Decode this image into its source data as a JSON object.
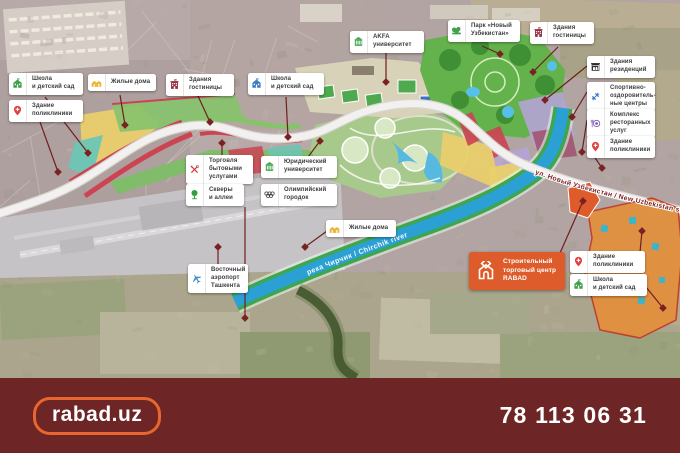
{
  "map": {
    "street_label": "ул. Новый Узбекистан / New Uzbekistan str.",
    "river_label": "река Чирчик / Chirchik river"
  },
  "labels": [
    {
      "name": "school-kindergarten-1",
      "icon": "school",
      "color": "#3fa24a",
      "x": 9,
      "y": 73,
      "w": 74,
      "lines": [
        "Школа",
        "и детский сад"
      ]
    },
    {
      "name": "residential-1",
      "icon": "houses",
      "color": "#eab73a",
      "x": 88,
      "y": 74,
      "w": 68,
      "lines": [
        "Жилые дома"
      ]
    },
    {
      "name": "hotel-1",
      "icon": "hotel",
      "color": "#93303f",
      "x": 166,
      "y": 74,
      "w": 68,
      "lines": [
        "Здания",
        "гостиницы"
      ]
    },
    {
      "name": "polyclinic-1",
      "icon": "pin",
      "color": "#e04040",
      "x": 9,
      "y": 100,
      "w": 74,
      "lines": [
        "Здание",
        "поликлиники"
      ]
    },
    {
      "name": "school-kindergarten-2",
      "icon": "school",
      "color": "#3d7dc0",
      "x": 248,
      "y": 73,
      "w": 76,
      "lines": [
        "Школа",
        "и детский сад"
      ]
    },
    {
      "name": "akfa-university",
      "icon": "university",
      "color": "#3fa24a",
      "x": 350,
      "y": 31,
      "w": 74,
      "lines": [
        "AKFA",
        "университет"
      ]
    },
    {
      "name": "park-new-uzbekistan",
      "icon": "park",
      "color": "#3fa24a",
      "x": 448,
      "y": 20,
      "w": 72,
      "lines": [
        "Парк «Новый",
        "Узбекистан»"
      ]
    },
    {
      "name": "hotel-2",
      "icon": "hotel",
      "color": "#93303f",
      "x": 530,
      "y": 22,
      "w": 64,
      "lines": [
        "Здания",
        "гостиницы"
      ]
    },
    {
      "name": "residences",
      "icon": "palace",
      "color": "#2e2e2e",
      "x": 587,
      "y": 56,
      "w": 68,
      "lines": [
        "Здания",
        "резиденций"
      ]
    },
    {
      "name": "sports-centers",
      "icon": "dumbbell",
      "color": "#3d7dc0",
      "x": 587,
      "y": 82,
      "w": 68,
      "lines": [
        "Спортивно-",
        "оздоровитель-",
        "ные центры"
      ]
    },
    {
      "name": "restaurant-complex",
      "icon": "restaurant",
      "color": "#7e57b0",
      "x": 587,
      "y": 109,
      "w": 68,
      "lines": [
        "Комплекс",
        "ресторанных",
        "услуг"
      ]
    },
    {
      "name": "polyclinic-2",
      "icon": "pin",
      "color": "#e04040",
      "x": 587,
      "y": 136,
      "w": 68,
      "lines": [
        "Здание",
        "поликлиники"
      ]
    },
    {
      "name": "household-services",
      "icon": "tools",
      "color": "#d03a3a",
      "x": 186,
      "y": 155,
      "w": 67,
      "lines": [
        "Торговля",
        "бытовыми",
        "услугами"
      ]
    },
    {
      "name": "law-university",
      "icon": "university",
      "color": "#3fa24a",
      "x": 261,
      "y": 156,
      "w": 76,
      "lines": [
        "Юридический",
        "университет"
      ]
    },
    {
      "name": "parks-and-alleys",
      "icon": "tree",
      "color": "#2fa03a",
      "x": 186,
      "y": 184,
      "w": 58,
      "lines": [
        "Скверы",
        "и аллеи"
      ]
    },
    {
      "name": "olympic-town",
      "icon": "olympic",
      "color": "#3a3a3a",
      "x": 261,
      "y": 184,
      "w": 76,
      "lines": [
        "Олимпийский",
        "городок"
      ]
    },
    {
      "name": "residential-2",
      "icon": "houses",
      "color": "#eab73a",
      "x": 326,
      "y": 220,
      "w": 70,
      "lines": [
        "Жилые дома"
      ]
    },
    {
      "name": "east-airport",
      "icon": "airplane",
      "color": "#4a90c4",
      "x": 188,
      "y": 264,
      "w": 60,
      "lines": [
        "Восточный",
        "аэропорт",
        "Ташкента"
      ]
    },
    {
      "name": "polyclinic-3",
      "icon": "pin",
      "color": "#e04040",
      "x": 570,
      "y": 251,
      "w": 75,
      "lines": [
        "Здание",
        "поликлиники"
      ]
    },
    {
      "name": "school-kindergarten-3",
      "icon": "school",
      "color": "#3fa24a",
      "x": 570,
      "y": 274,
      "w": 77,
      "lines": [
        "Школа",
        "и детский сад"
      ]
    }
  ],
  "cta": {
    "bg": "#de5c2b",
    "lines": [
      "Строительный",
      "торговый центр",
      "RABAD"
    ]
  },
  "footer": {
    "logo": "rabad.uz",
    "phone": "78 113 06 31",
    "bg": "#6d2525",
    "accent": "#e8662f"
  }
}
